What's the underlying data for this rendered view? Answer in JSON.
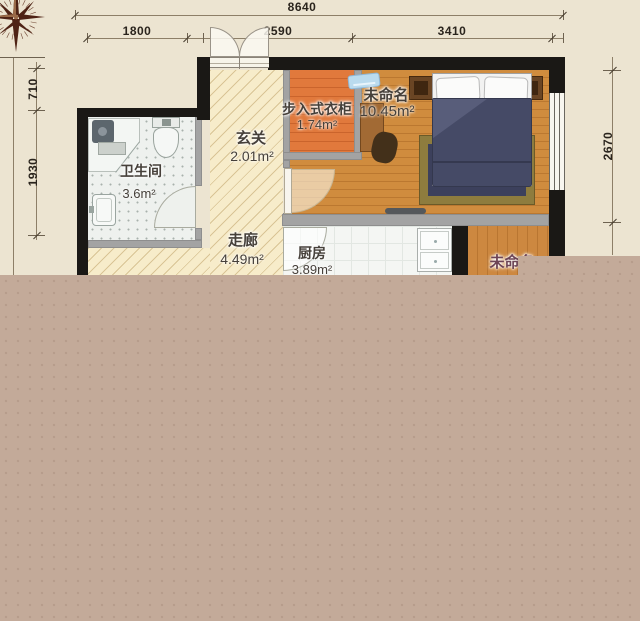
{
  "rooms": {
    "closet": {
      "name": "步入式衣柜",
      "area": "1.74m²"
    },
    "bedroom": {
      "name": "未命名",
      "area": "10.45m²"
    },
    "foyer": {
      "name": "玄关",
      "area": "2.01m²"
    },
    "bathroom": {
      "name": "卫生间",
      "area": "3.6m²"
    },
    "corridor": {
      "name": "走廊",
      "area": "4.49m²"
    },
    "kitchen": {
      "name": "厨房",
      "area": "3.89m²"
    },
    "unnamed2": {
      "name": "未命名"
    }
  },
  "dimensions": {
    "top_total": "8640",
    "top_left": "1800",
    "top_mid": "2590",
    "top_right": "3410",
    "left_upper": "710",
    "left_lower": "1930",
    "right_side": "2670"
  },
  "icons": {
    "compass": "compass-rose"
  },
  "colors": {
    "paper": "#ece4d1",
    "overlay_block": "#c3aa99",
    "exterior_wall": "#1a1815",
    "interior_wall": "#a3a3a3",
    "bedroom_floor": "#d08c3e",
    "closet_floor": "#e1793c",
    "hallway_floor": "#f7ecca",
    "bed_blanket": "#454a66",
    "rug_border": "#8e7c3e"
  }
}
